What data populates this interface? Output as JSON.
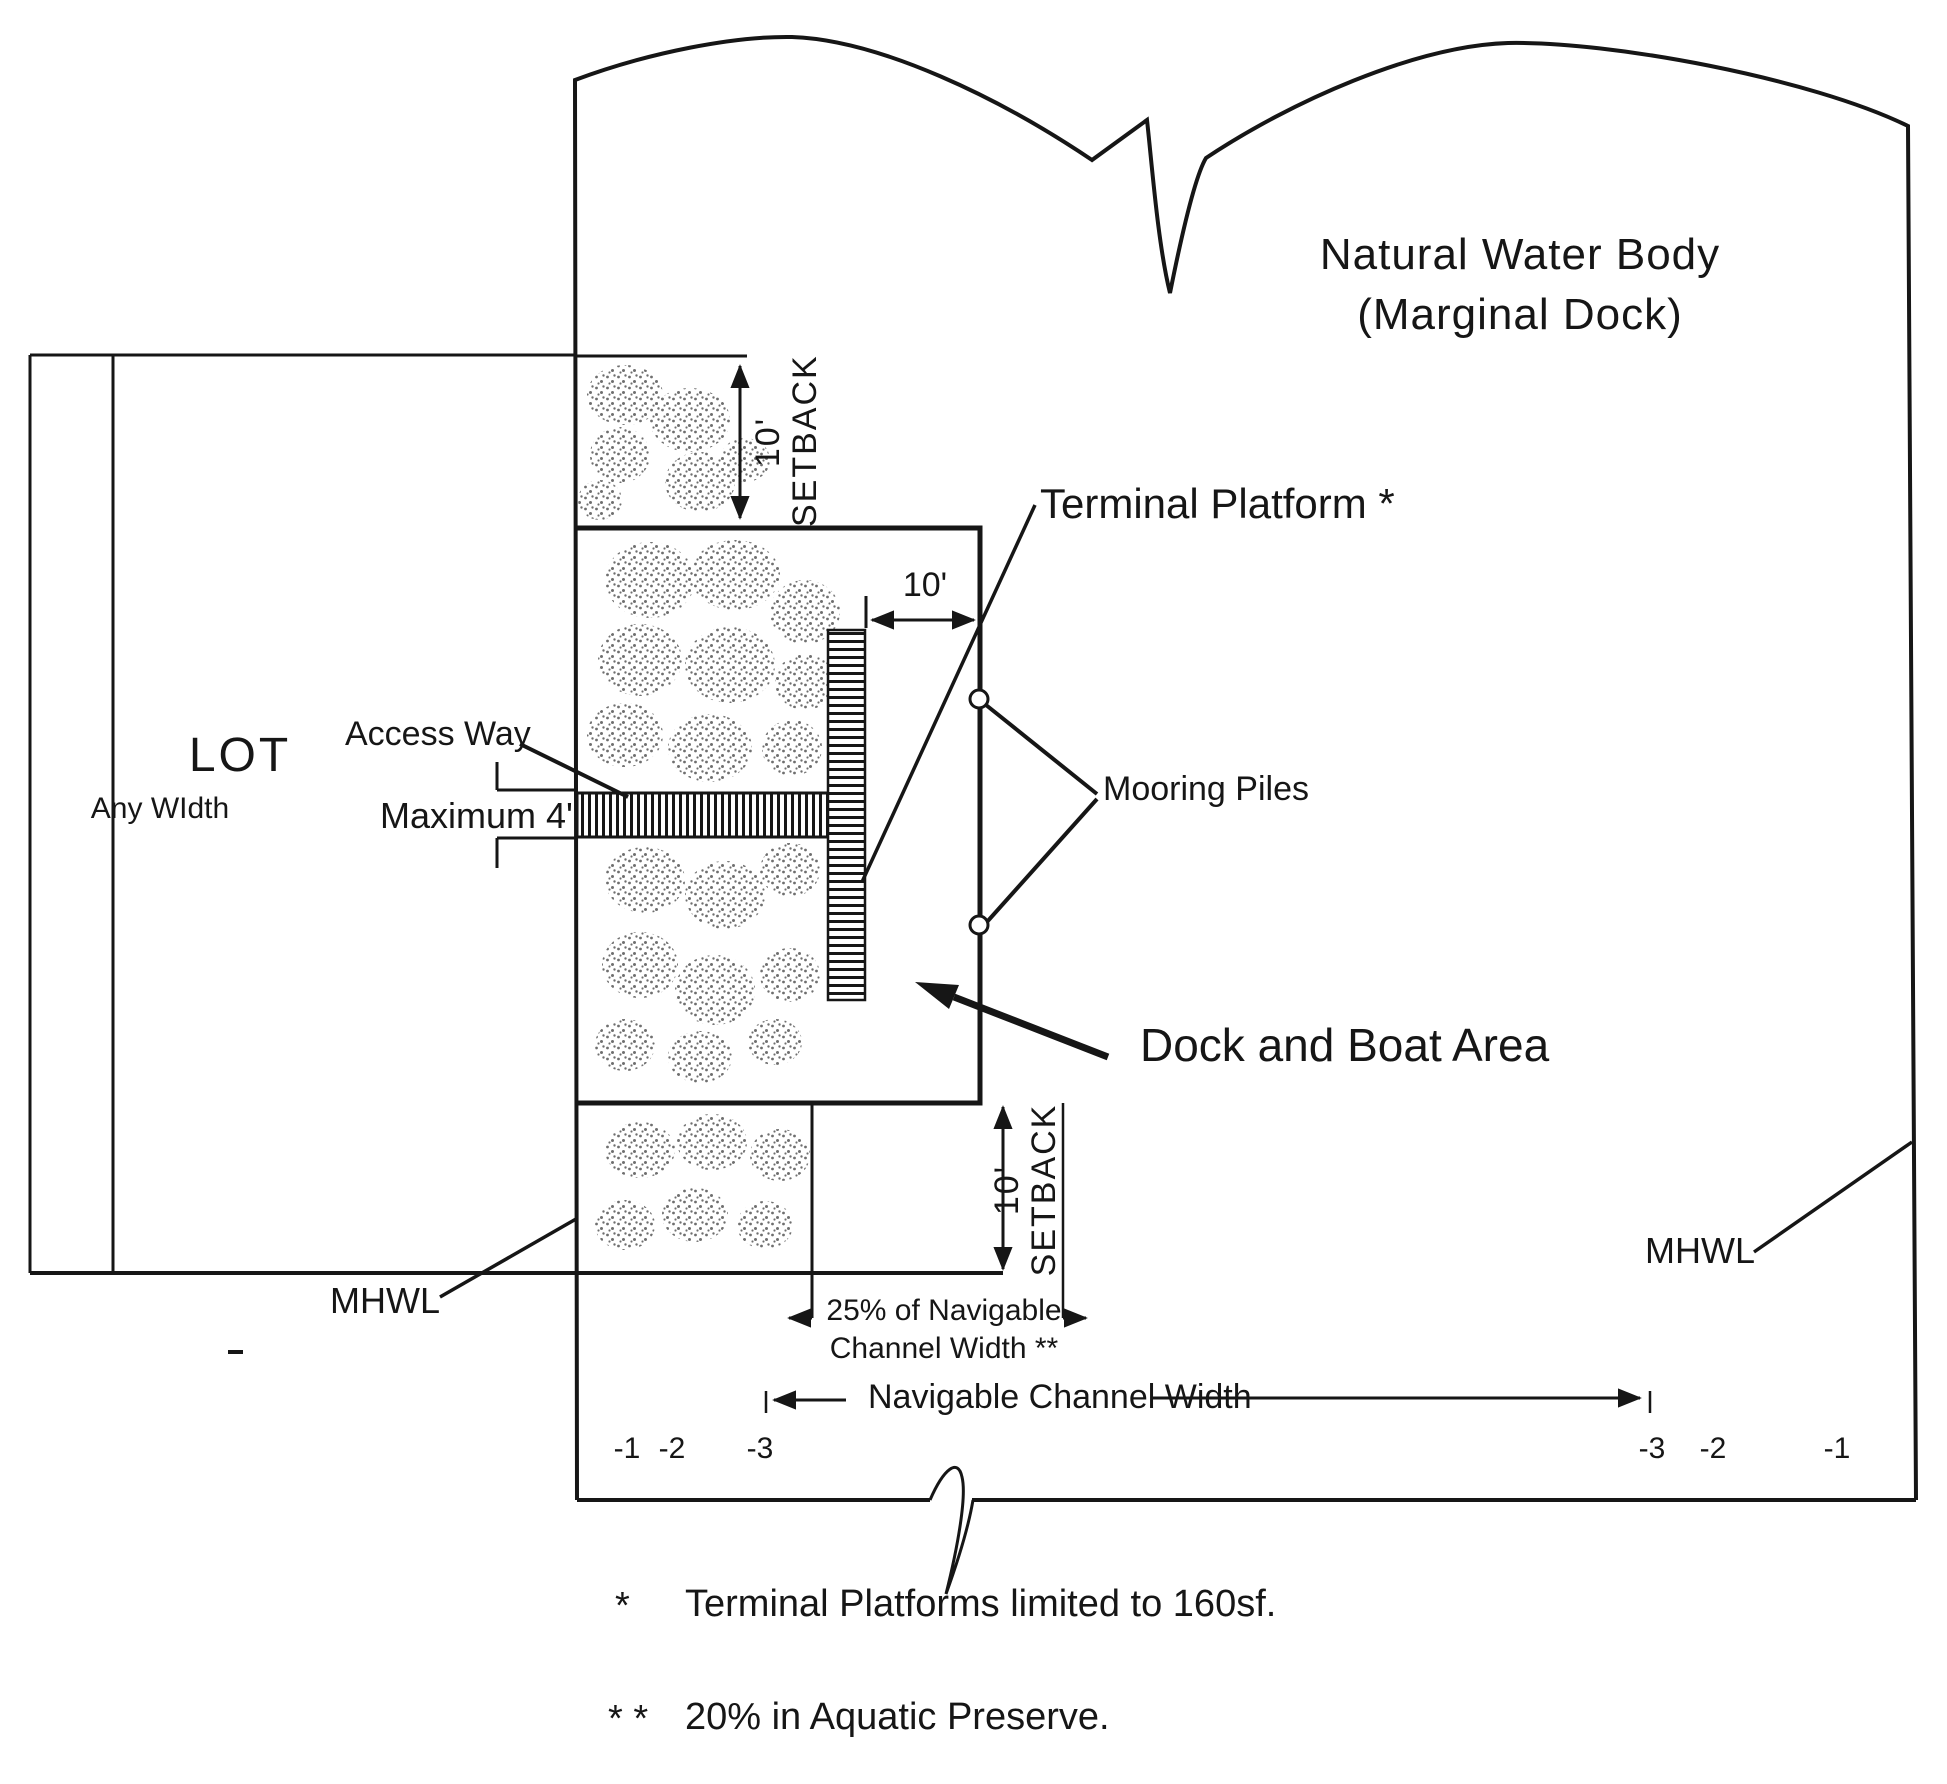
{
  "diagram": {
    "title_line1": "Natural Water Body",
    "title_line2": "(Marginal Dock)",
    "lot_label": "LOT",
    "lot_width_note": "Any WIdth",
    "access_way_label": "Access Way",
    "access_way_max": "Maximum 4'",
    "terminal_platform_label": "Terminal Platform *",
    "terminal_platform_width": "10'",
    "mooring_piles_label": "Mooring Piles",
    "dock_boat_area_label": "Dock and Boat Area",
    "mhwl_left": "MHWL",
    "mhwl_right": "MHWL",
    "setback_top_value": "10'",
    "setback_top_word": "SETBACK",
    "setback_bottom_value": "10'",
    "setback_bottom_word": "SETBACK",
    "channel_limit_line1": "25% of Navigable",
    "channel_limit_line2": "Channel Width **",
    "navigable_channel_label": "Navigable Channel Width",
    "depths_left": [
      "-1",
      "-2",
      "-3"
    ],
    "depths_right": [
      "-3",
      "-2",
      "-1"
    ],
    "footnotes": [
      {
        "marker": "*",
        "text": "Terminal Platforms limited to 160sf."
      },
      {
        "marker": "* *",
        "text": "20% in Aquatic Preserve."
      }
    ]
  },
  "colors": {
    "ink": "#161616",
    "paper": "#ffffff",
    "stipple": "#6f6f6f"
  }
}
